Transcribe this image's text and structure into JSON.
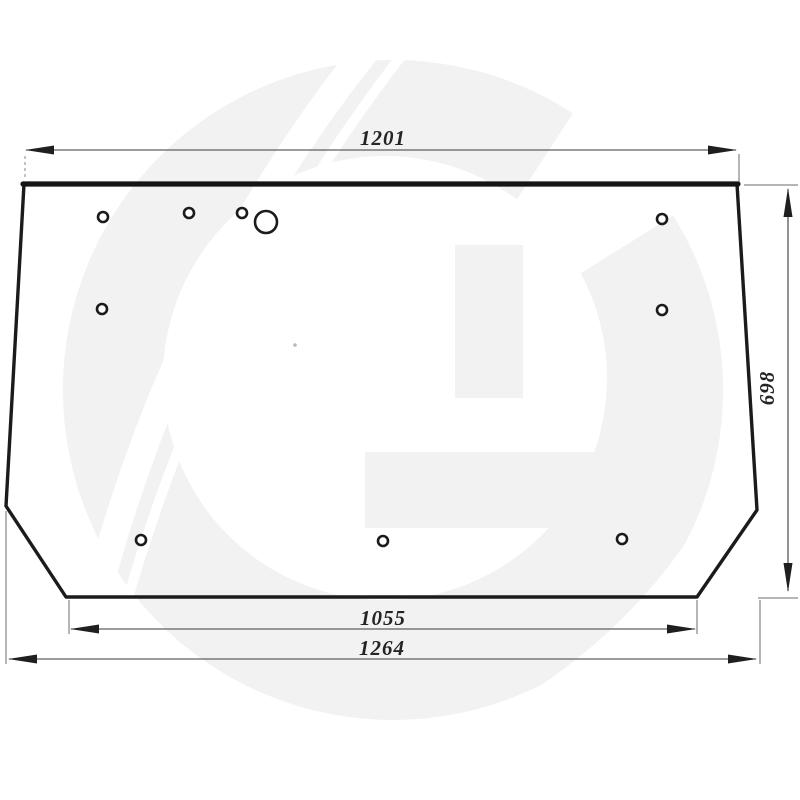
{
  "diagram": {
    "watermark": {
      "letter": "G",
      "color": "#f2f2f2"
    },
    "dimensions": {
      "top_width": "1201",
      "side_height": "698",
      "bottom_inner_width": "1055",
      "bottom_overall_width": "1264"
    },
    "holes": [
      {
        "cx": 103,
        "cy": 217,
        "r": 5
      },
      {
        "cx": 189,
        "cy": 213,
        "r": 5
      },
      {
        "cx": 242,
        "cy": 213,
        "r": 5
      },
      {
        "cx": 266,
        "cy": 222,
        "r": 11
      },
      {
        "cx": 662,
        "cy": 219,
        "r": 5
      },
      {
        "cx": 102,
        "cy": 309,
        "r": 5
      },
      {
        "cx": 662,
        "cy": 310,
        "r": 5
      },
      {
        "cx": 141,
        "cy": 540,
        "r": 5
      },
      {
        "cx": 383,
        "cy": 541,
        "r": 5
      },
      {
        "cx": 622,
        "cy": 539,
        "r": 5
      }
    ],
    "artifacts": [
      {
        "x": 295,
        "y": 345,
        "r": 1.8
      }
    ],
    "colors": {
      "outline": "#1b1b1b",
      "dimension": "#3a3a3a",
      "background": "#ffffff"
    }
  }
}
